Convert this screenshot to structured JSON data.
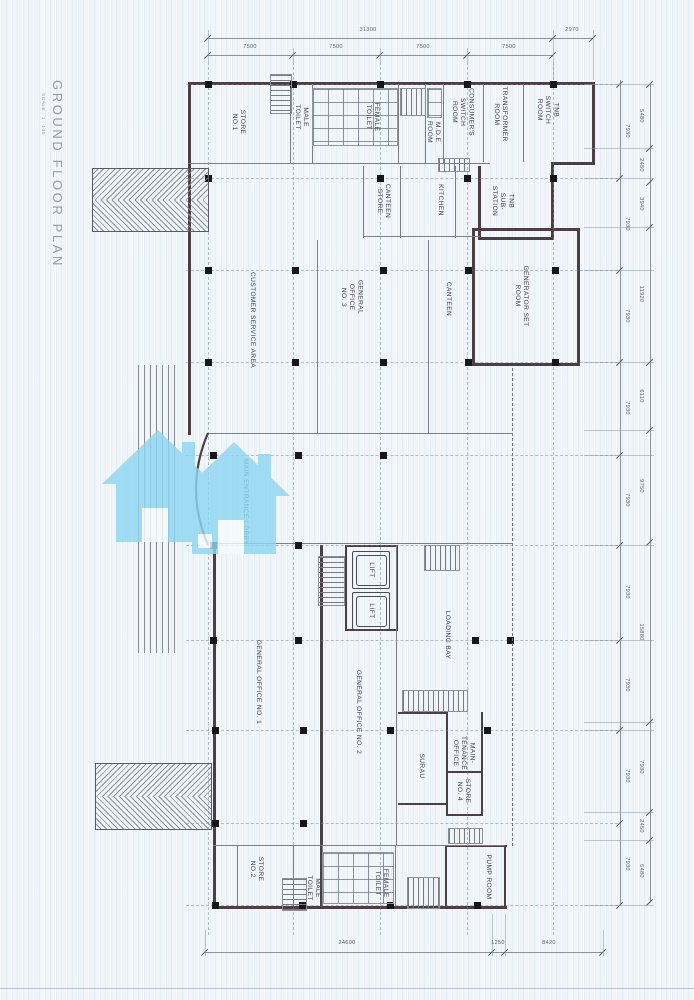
{
  "document": {
    "title": "GROUND FLOOR PLAN",
    "scale_note": "SCALE : 1 : 100"
  },
  "rooms": {
    "store_no_1": "STORE\nNO.1",
    "male_toilet_top": "MALE\nTOILET",
    "female_toilet_top": "FEMALE\nTOILET",
    "mde_room": "M.D.E\nROOM",
    "consumers_switch_room": "CONSUMER'S\nSWITCH\nROOM",
    "transformer_room": "TRANSFORMER\nROOM",
    "tnb_switch_room": "TNB\nSWITCH\nROOM",
    "canteen_store": "CANTEEN\nSTORE",
    "kitchen": "KITCHEN",
    "tnb_substation": "TNB\nSUB-\nSTATION",
    "customer_service_area": "CUSTOMER SERVICE AREA",
    "general_office_3": "GENERAL\nOFFICE\nNO. 3",
    "canteen": "CANTEEN",
    "generator_set_room": "GENERATOR SET\nROOM",
    "main_entrance_lobby": "MAIN ENTRANCE LOBBY",
    "lift_upper": "LIFT",
    "lift_lower": "LIFT",
    "loading_bay": "LOADING BAY",
    "general_office_1": "GENERAL OFFICE NO. 1",
    "general_office_2": "GENERAL OFFICE NO. 2",
    "surau": "SURAU",
    "maintenance_office": "MAIN-\nTENANCE\nOFFICE",
    "store_no_4": "STORE\nNO. 4",
    "store_no_2": "STORE\nNO.2",
    "male_toilet_bottom": "MALE\nTOILET",
    "female_toilet_bottom": "FEMALE\nTOILET",
    "pump_room": "PUMP ROOM"
  },
  "dimensions": {
    "top_overall": [
      "31300",
      "2970"
    ],
    "top_bays": [
      "7500",
      "7500",
      "7500",
      "7500"
    ],
    "right_inner": [
      "7930",
      "7930",
      "7930",
      "7930",
      "7930",
      "7930",
      "7930",
      "7930",
      "7930"
    ],
    "right_outer": [
      "5480",
      "2450",
      "3940",
      "11920",
      "6110",
      "9750",
      "15880",
      "7930",
      "2450",
      "5480"
    ],
    "bottom": [
      "24600",
      "1250",
      "8420"
    ]
  },
  "watermark": {
    "color": "#8ed7f2"
  }
}
